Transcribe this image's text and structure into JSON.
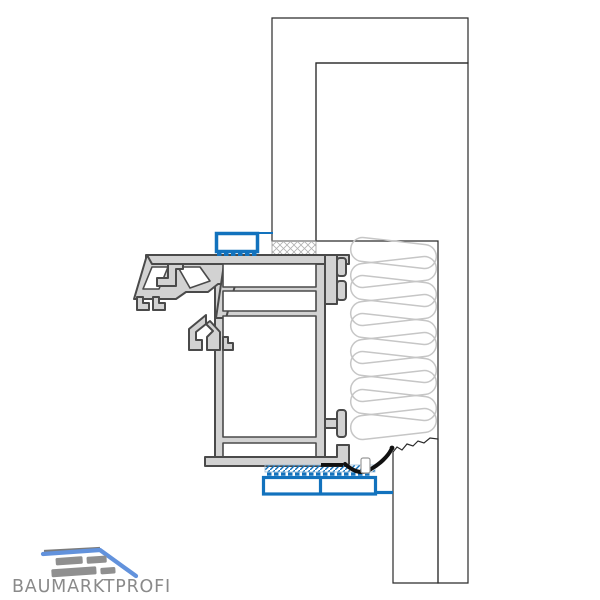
{
  "title": "Window frame installation section detail drawing",
  "logo": {
    "text": "BAUMARKTPROFI"
  },
  "colors": {
    "accent_blue": "#1272bd",
    "logo_blue": "#6292dc",
    "logo_gray": "#8a8a8a",
    "frame_fill": "#d2d2d2",
    "frame_outline": "#4a4a4a",
    "drawing_line": "#2a2a2a",
    "membrane_black": "#111111",
    "insulation_stroke": "#c6c6c6",
    "crosshatch_gray": "#b2b2b2"
  },
  "insulation": {
    "loop_count": 10
  },
  "components": [
    "exterior-plaster-layer",
    "brick-masonry-wall",
    "mortar-joint",
    "joint-insulation",
    "pvc-window-frame-profile",
    "top-connection-profile",
    "sill-connection-profile",
    "compression-sealing-tape",
    "sealing-membrane",
    "plaster-bottom-strip",
    "baumarktprofi-logo"
  ]
}
